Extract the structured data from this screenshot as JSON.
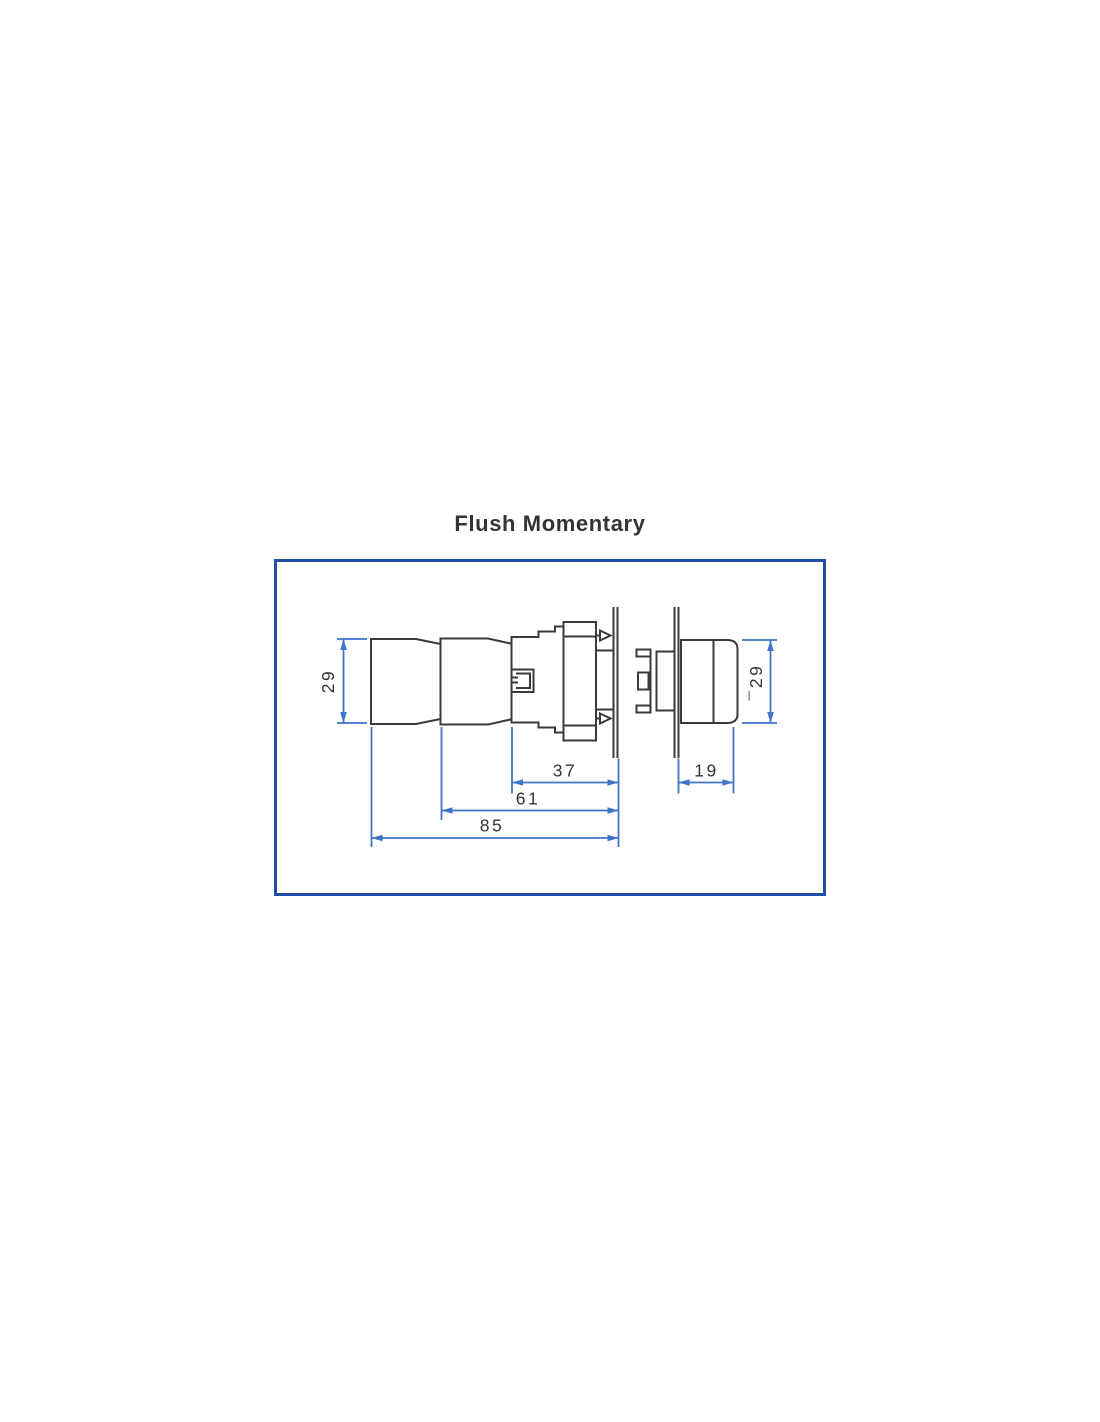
{
  "page": {
    "title": "Flush Momentary"
  },
  "diagram": {
    "type": "technical-dimension-drawing",
    "subject": "flush momentary push button switch, side view, exploded through two panel sections",
    "dimensions": {
      "height_left": "29",
      "height_right": "¯29",
      "behind_panel_depth": "37",
      "body_length": "61",
      "total_length": "85",
      "head_projection": "19"
    },
    "colors": {
      "outline": "#3a3a38",
      "dimension": "#3f74c8",
      "border": "#1e4ea6",
      "text": "#333333",
      "background": "#ffffff"
    }
  }
}
